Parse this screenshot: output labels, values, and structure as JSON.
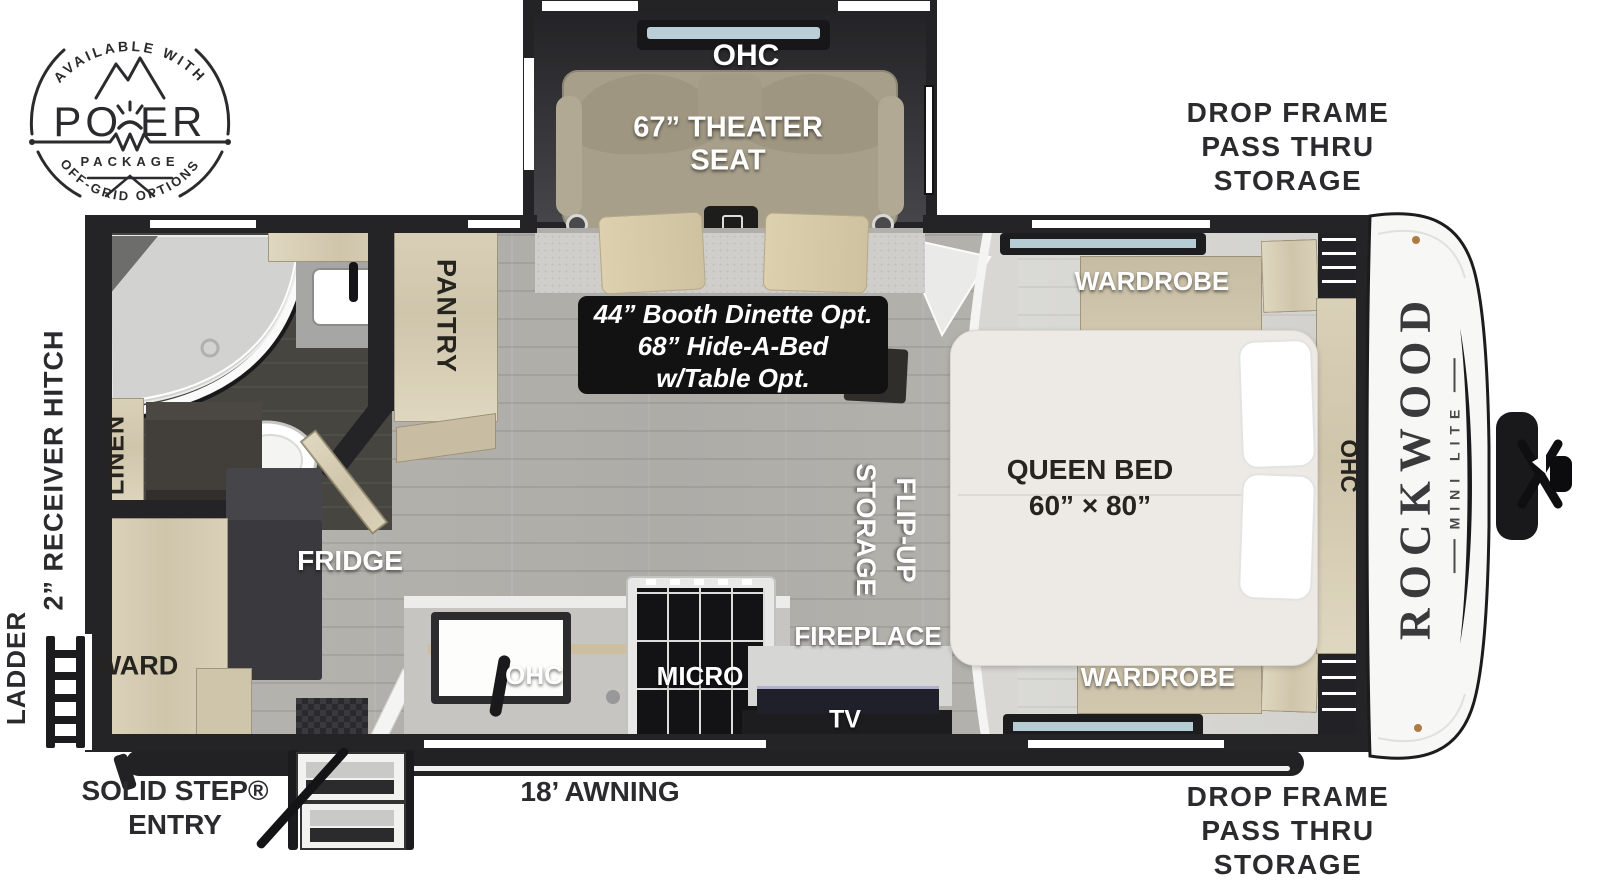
{
  "logo": {
    "arc_top": "AVAILABLE WITH",
    "power_p1": "PO",
    "power_p2": "ER",
    "package": "PACKAGE",
    "arc_bottom": "OFF-GRID OPTIONS"
  },
  "exterior": {
    "drop_top_l1": "DROP FRAME",
    "drop_top_l2": "PASS THRU",
    "drop_top_l3": "STORAGE",
    "drop_bottom_l1": "DROP FRAME",
    "drop_bottom_l2": "PASS THRU",
    "drop_bottom_l3": "STORAGE",
    "receiver_hitch": "2” RECEIVER HITCH",
    "ladder": "LADDER",
    "solid_step_l1": "SOLID STEP®",
    "solid_step_l2": "ENTRY",
    "awning": "18’ AWNING"
  },
  "slideout": {
    "ohc": "OHC",
    "theater_l1": "67” THEATER",
    "theater_l2": "SEAT"
  },
  "interior": {
    "option_l1": "44” Booth Dinette Opt.",
    "option_l2": "68” Hide-A-Bed",
    "option_l3": "w/Table Opt.",
    "pantry": "PANTRY",
    "linen": "LINEN",
    "ward": "WARD",
    "fridge": "FRIDGE",
    "kitchen_ohc": "OHC",
    "micro": "MICRO",
    "fireplace": "FIREPLACE",
    "tv": "TV",
    "flip_l1": "FLIP-UP",
    "flip_l2": "STORAGE"
  },
  "bedroom": {
    "queen_l1": "QUEEN BED",
    "queen_l2": "60” × 80”",
    "wardrobe_top": "WARDROBE",
    "wardrobe_bottom": "WARDROBE",
    "ohc": "OHC"
  },
  "brand": {
    "name": "ROCKWOOD",
    "sub": "MINI LITE"
  },
  "colors": {
    "wall": "#242427",
    "floor_main": "#b4b2ad",
    "floor_bedroom": "#d8d7d3",
    "cabinet_wood": "#d5cbb2",
    "seat": "#a79f8a",
    "option_box_bg": "#121212",
    "label_dark": "#2b2b2e"
  }
}
